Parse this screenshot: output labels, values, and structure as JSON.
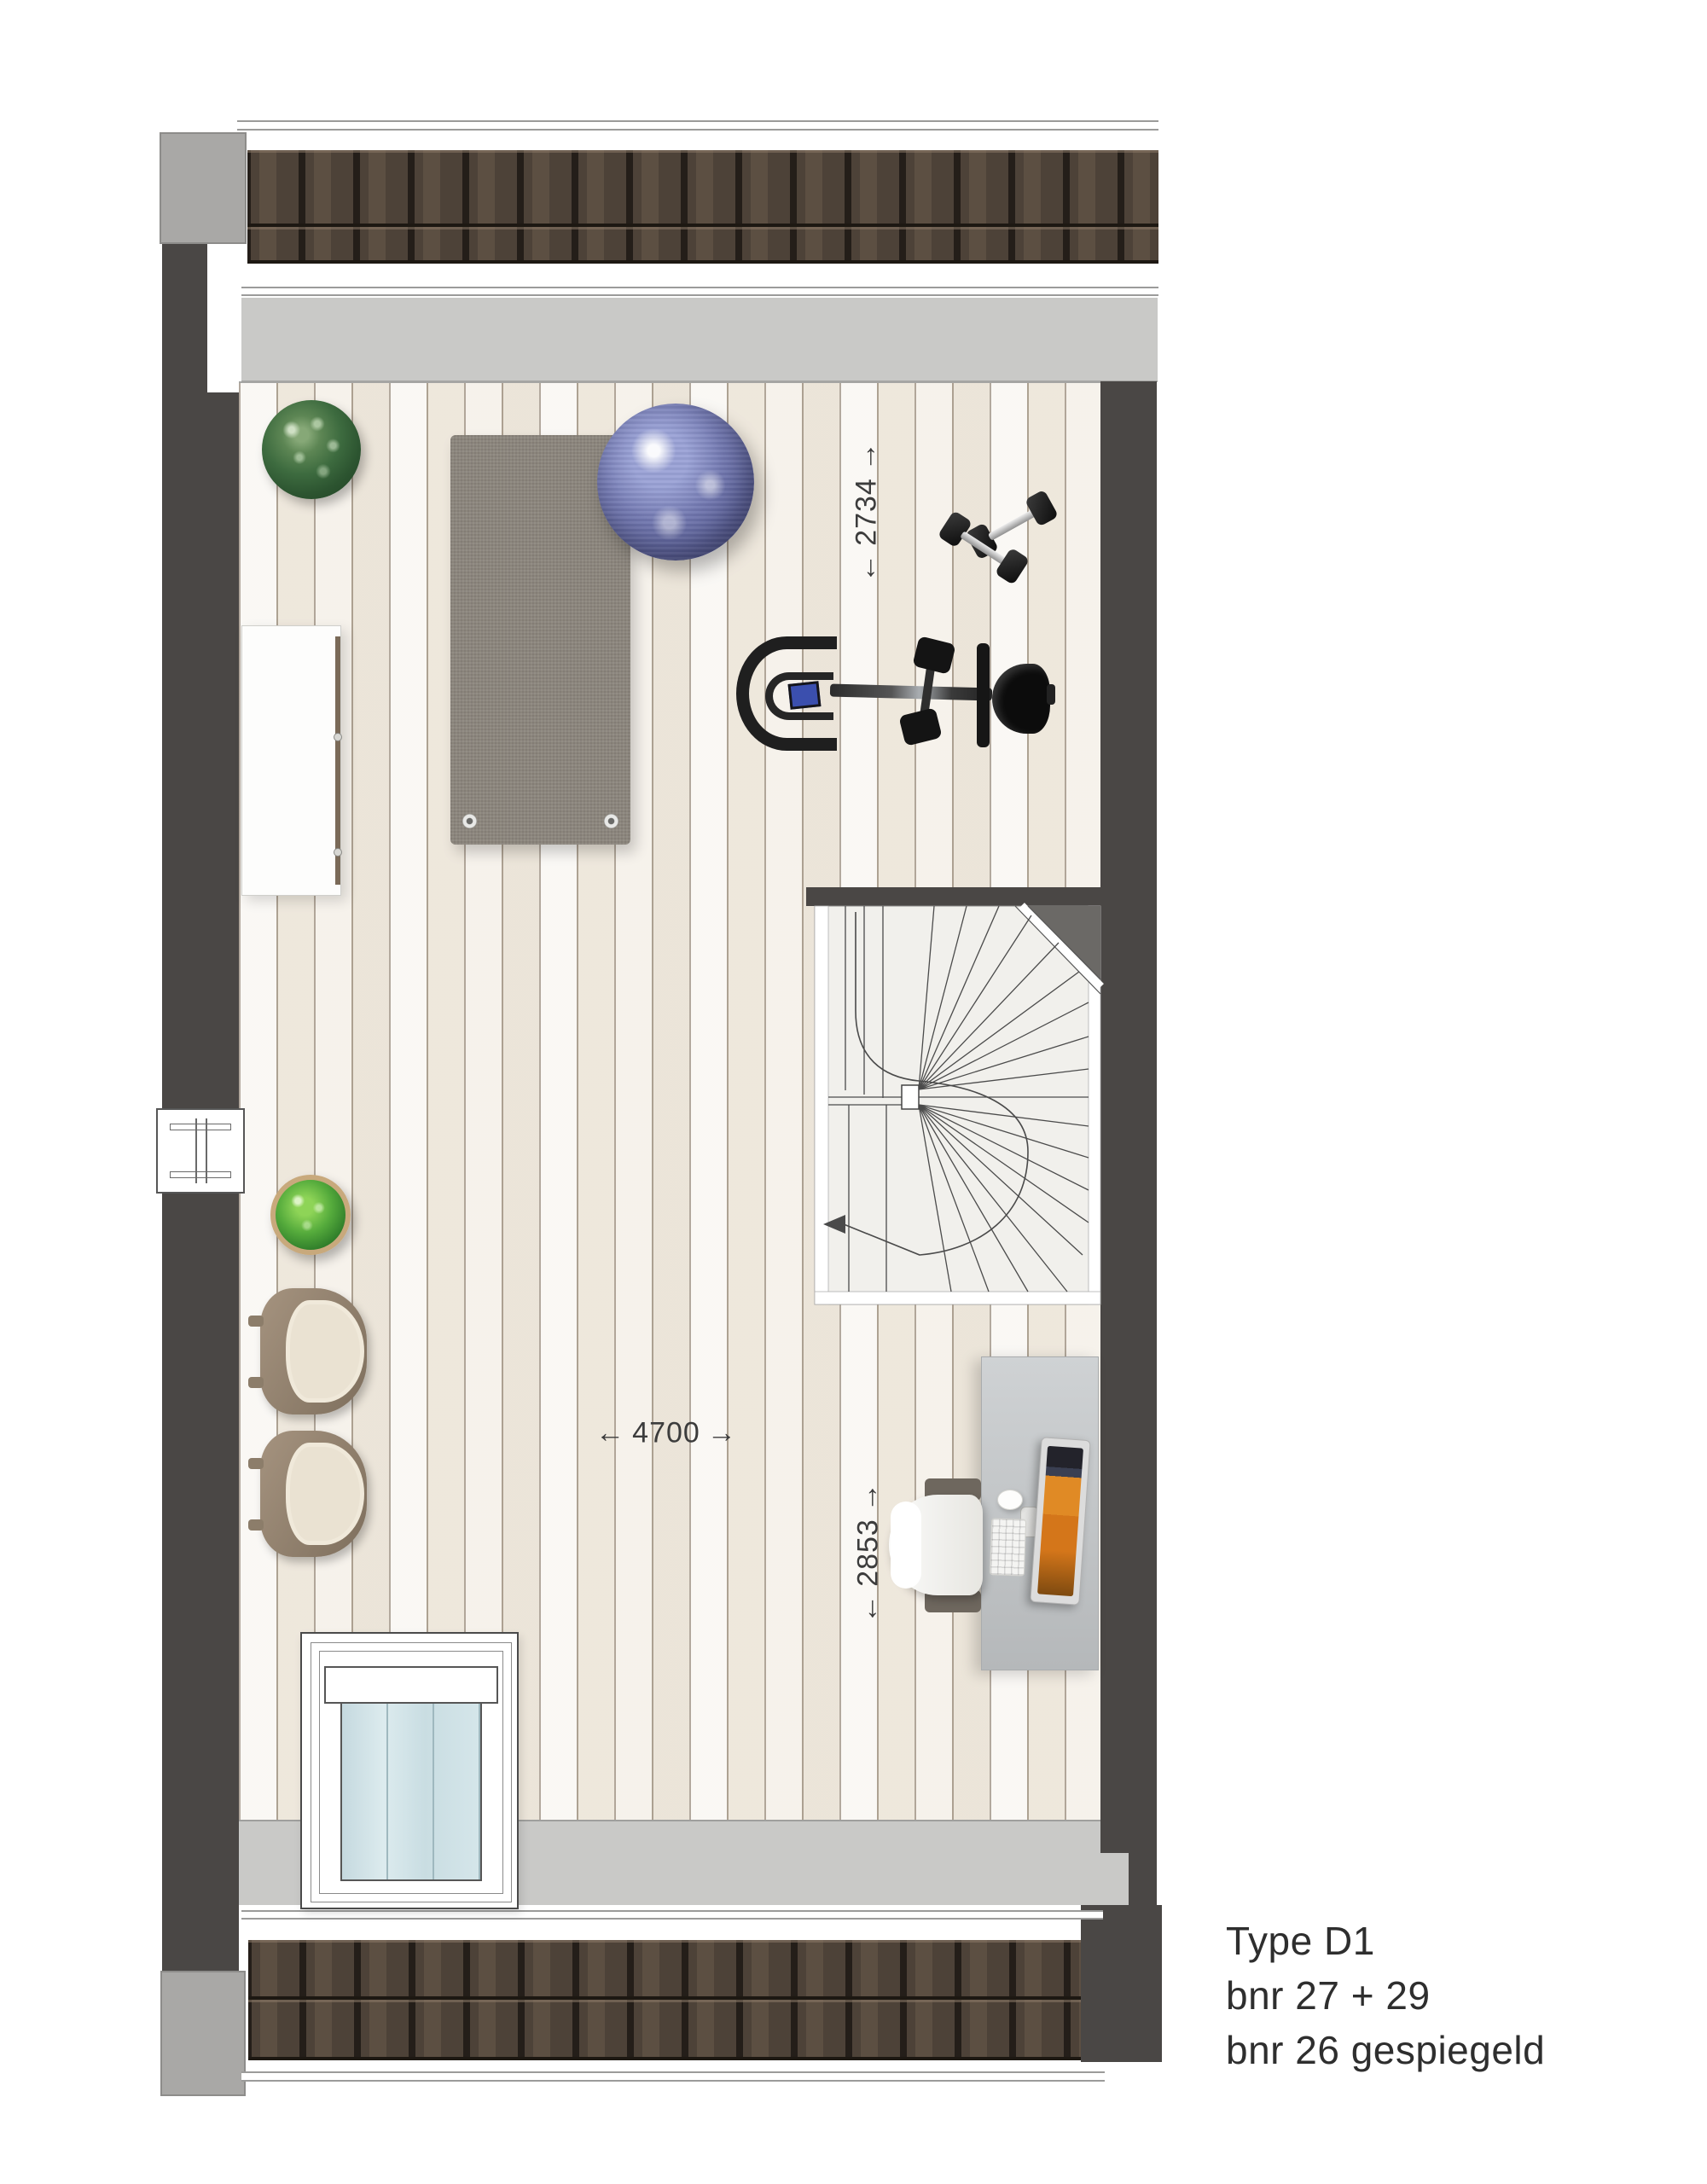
{
  "caption": {
    "line1": "Type D1",
    "line2": "bnr 27 + 29",
    "line3": "bnr 26 gespiegeld"
  },
  "dimensions": {
    "attic_width": {
      "arrow_left": "←",
      "value": "2734",
      "arrow_right": "→"
    },
    "room_width": {
      "arrow_left": "←",
      "value": "4700",
      "arrow_right": "→"
    },
    "desk_zone_depth": {
      "arrow_left": "←",
      "value": "2853",
      "arrow_right": "→"
    }
  },
  "colors": {
    "wall": "#4a4745",
    "roof_tile": "#453a31",
    "slope_band": "#c9c9c7",
    "chimney": "#a9a8a6",
    "floor": "#f3efe8",
    "stair_floor": "#f1f0ec",
    "yoga_mat": "#8b857c",
    "exercise_ball": "#6c71a8",
    "desk": "#c3c6c8",
    "caption_text": "#2e2e2e"
  },
  "objects": {
    "plant_top": "potted-plant",
    "plant_left": "potted-plant",
    "cabinet": "sideboard",
    "yoga_mat": "yoga-mat",
    "exercise_ball": "exercise-ball",
    "dumbbells": "dumbbells",
    "exercise_bike": "exercise-bike",
    "staircase": "spiral-staircase",
    "armchair_1": "armchair",
    "armchair_2": "armchair",
    "desk": "desk-with-computer",
    "skylight": "roof-window",
    "window_left": "window"
  }
}
